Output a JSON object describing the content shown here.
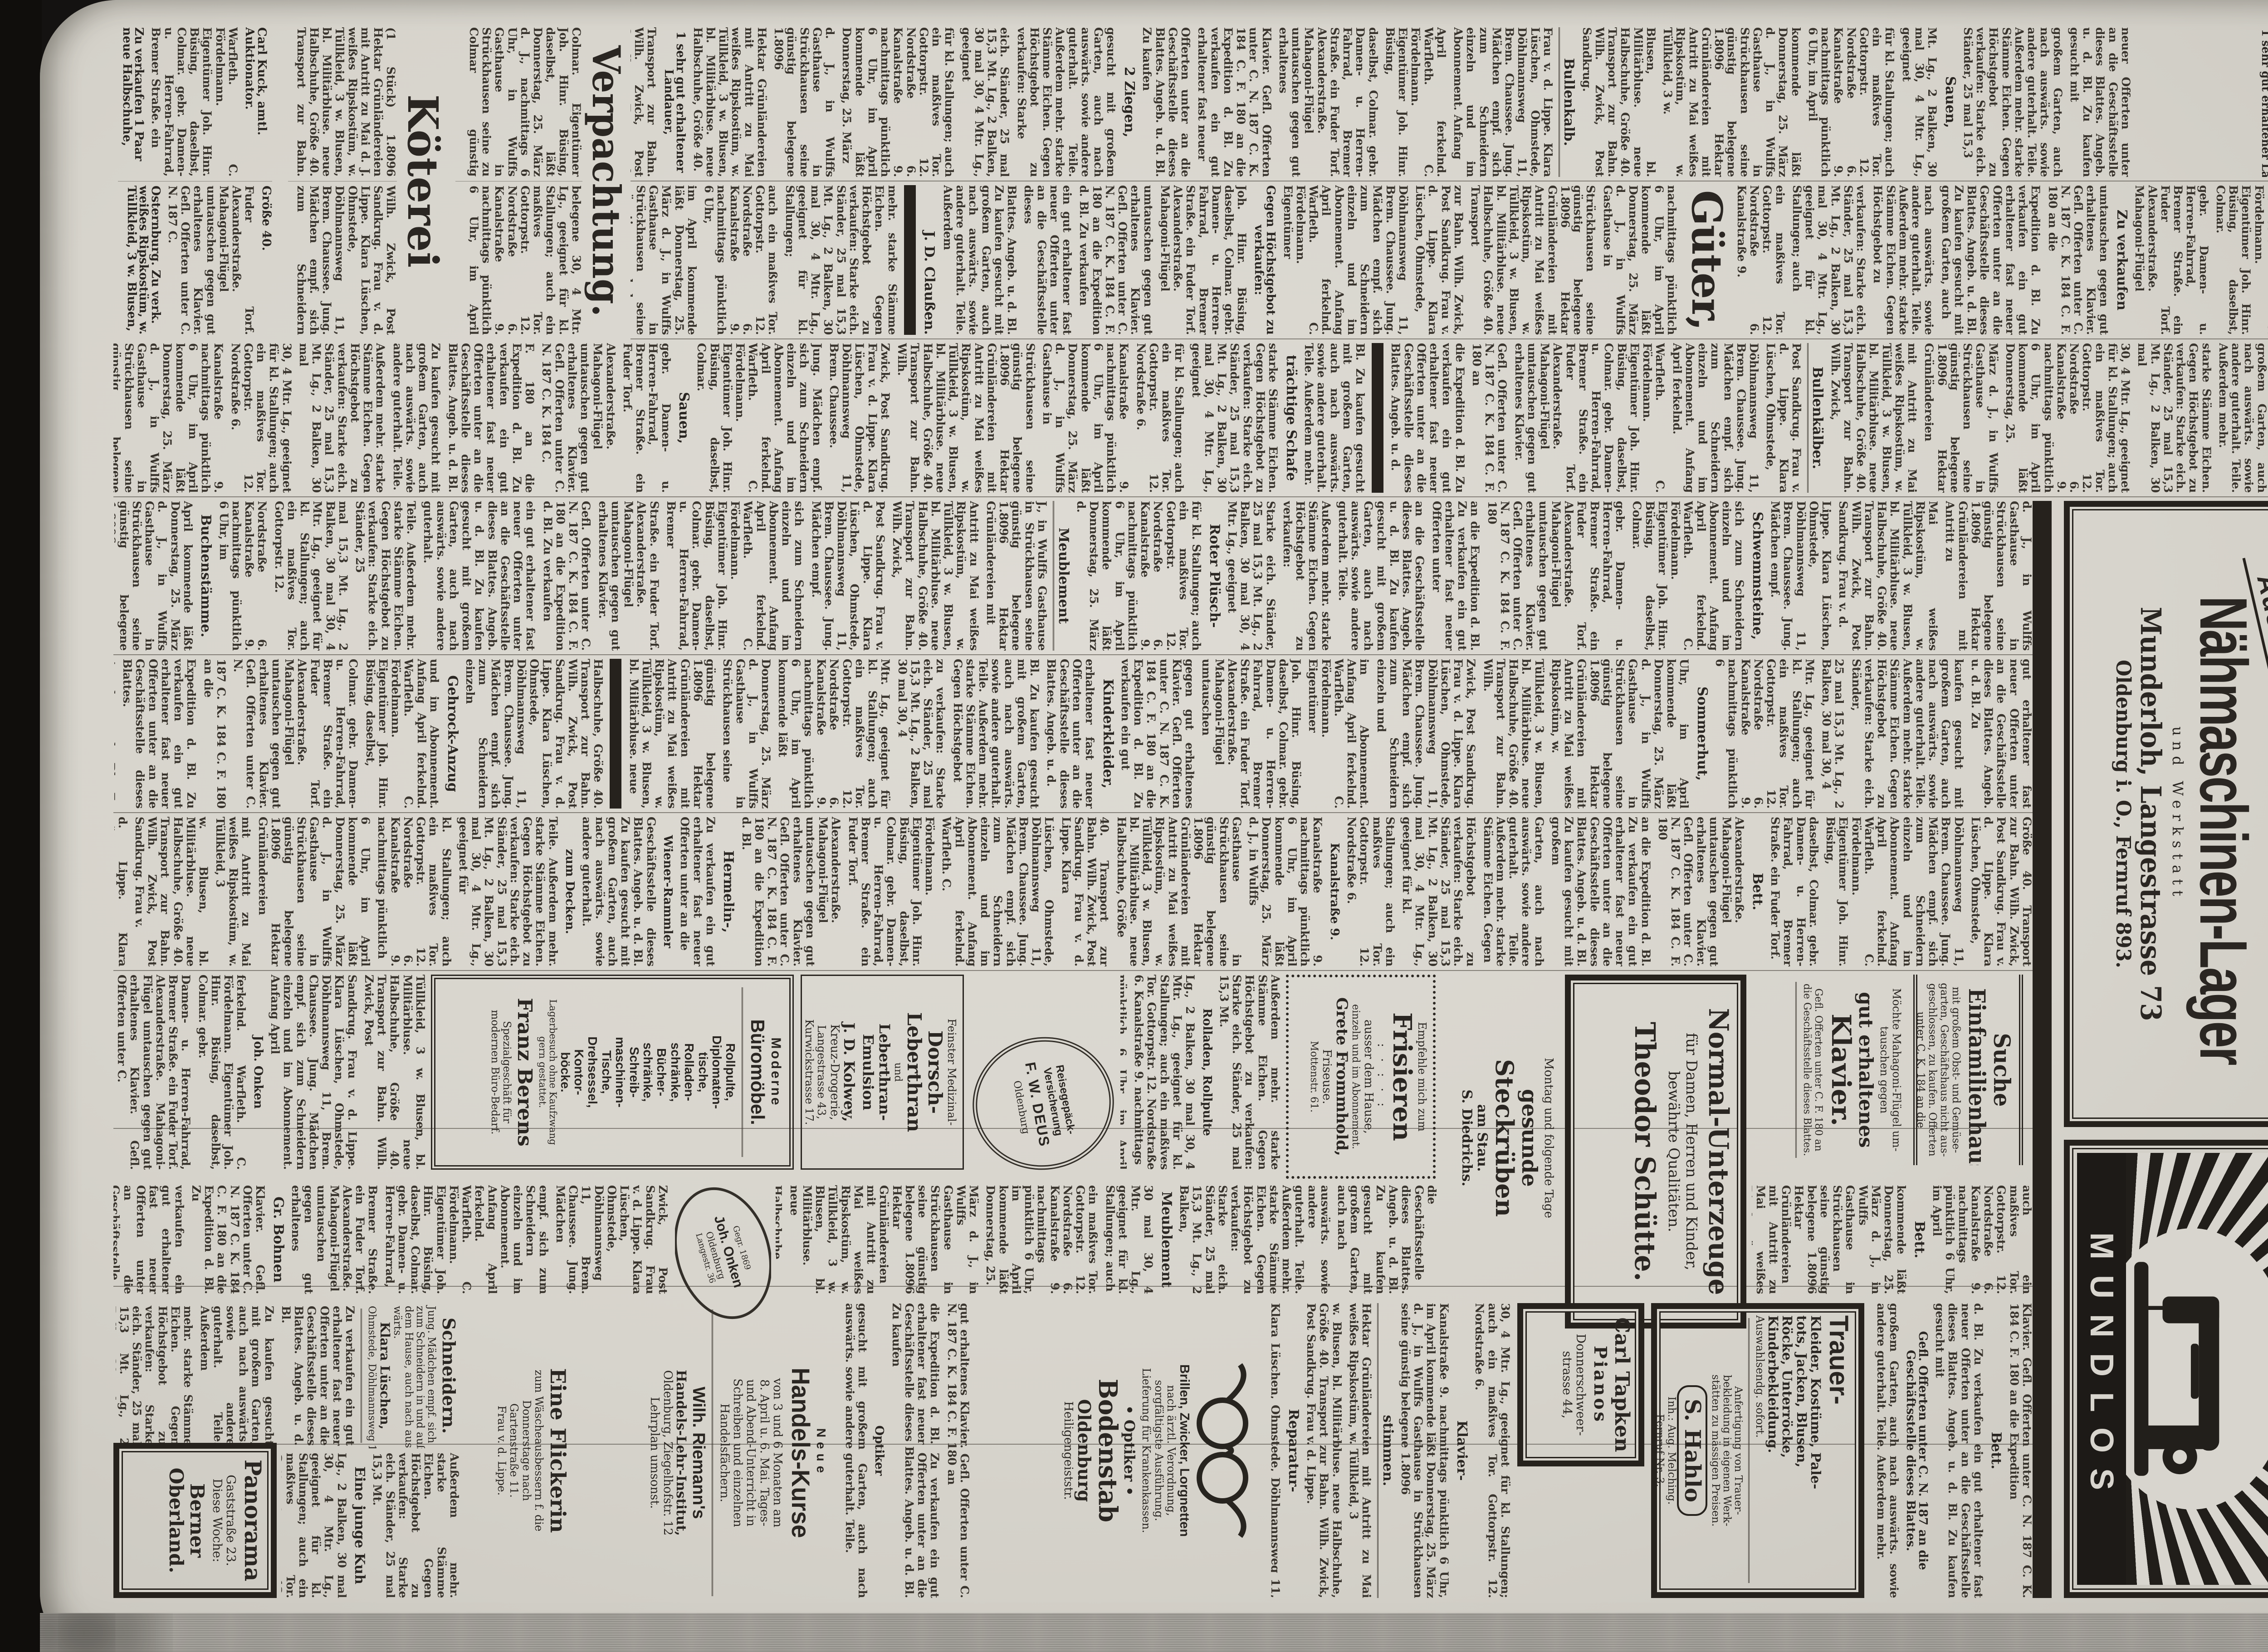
{
  "page_number": "889",
  "paper_colors": {
    "paper": "#d7d4cc",
    "ink": "#26221d",
    "faded_ink": "#39342d",
    "background": "#141211"
  },
  "masthead": {
    "title": "Nachzüge.",
    "lines": [
      "In der am",
      "Mittwoch, den 24. d. M.",
      "nachmittags pünktlich 1½ Uhr,",
      "stattfindenden Wagenauktion",
      "kommen ferner:"
    ],
    "items": [
      "1 Gespann bester ostpr. Pferde,",
      "1 10 Monat altes Bullenkalb,",
      "2 Ziegen, im April lammende,",
      "1 sehr gut erhaltener Landauer,"
    ]
  },
  "ads": {
    "munderloh": {
      "zahlung_box": "Alte Maschinen werden in Zahlung genommen",
      "auswahl": "Auswahl",
      "title": "Nähmaschinen-Lager",
      "sub": "und Werkstatt",
      "name_line": "Munderloh, Langestrasse 73",
      "city_line": "Oldenburg i. O., Fernruf 893."
    },
    "mundlos": {
      "brand": "MUNDLOS"
    },
    "suche_haus": [
      "Suche",
      "Einfamilienhaus",
      "mit großem Obst- und Gemüse-",
      "garten, Geschäftshaus nicht aus-",
      "geschlossen, zu kaufen. Offerten",
      "unter C. K. 184 an die",
      "Expedition d. Bl."
    ],
    "klavier": [
      "Möchte Mahagoni-Flügel um-",
      "tauschen gegen",
      "gut erhaltenes",
      "Klavier.",
      "Gefl. Offerten unter C. F. 180 an",
      "die Geschäftsstelle dieses Blattes."
    ],
    "schuette": [
      "Normal-Unterzeuge",
      "für Damen, Herren und Kinder,",
      "bewährte Qualitäten.",
      "Theodor Schütte."
    ],
    "steckrueben": [
      "Montag und folgende Tage",
      "gesunde",
      "Steckrüben",
      "am Stau.",
      "S. Diedrichs."
    ],
    "frisieren": [
      "Empfehle mich zum",
      "Frisieren",
      ": · : · :",
      "ausser dem Hause,",
      "einzeln und im Abonnement.",
      "Grete Frommhold,",
      "Friseuse.",
      "Mottenstr. 61."
    ],
    "trauer": [
      "Trauer-",
      "Kleider, Kostüme, Pale-",
      "tots, Jacken, Blusen,",
      "Röcke, Unterröcke,",
      "Kinderbekleidung.",
      "Auswahlsendg. sofort.",
      "Anfertigung von Trauer-",
      "bekleidung in eigenen Werk-",
      "stätten zu mässigen Preisen.",
      "S. Hahlo",
      "Inh.: Aug. Melching.",
      "Fernruf Nr. 3."
    ],
    "tapken": [
      "Carl Tapken",
      "Pianos",
      "Donnerschweer-",
      "strasse 44,"
    ],
    "optiker": [
      "Brillen, Zwicker, Lorgnetten",
      "nach ärztl. Verordnung,",
      "sorgfältigste Ausführung.",
      "Lieferung für Krankenkassen.",
      "• Optiker •",
      "Bodenstab",
      "Oldenburg",
      "Heiligengeiststr."
    ],
    "kurse": [
      "Neue",
      "Handels-Kurse",
      "von 3 und 6 Monaten am",
      "8. April u. 6. Mai. Tages-",
      "und Abend-Unterricht in",
      "Schreiben und einzelnen",
      "Handelsfächern.",
      "Wilh. Riemann's",
      "Handels-Lehr-Institut,",
      "Oldenburg, Ziegelhofstr. 12",
      "Lehrplan umsonst."
    ],
    "flickerin": [
      "Eine Flickerin",
      "zum Wäscheausbessern f. die",
      "Donnerstage nach",
      "Gartenstraße 11.",
      "Frau v. d. Lippe."
    ],
    "schneidern": [
      "Schneidern.",
      "Jung. Mädchen empf. sich",
      "zum Schneidern in und auß.",
      "dem Hause, auch nach aus-",
      "wärts.",
      "Klara Lüschen,",
      "Ohmstede, Döhlmannsweg 11."
    ],
    "panorama": [
      "Panorama",
      "Gaststraße 23.",
      "Diese Woche:",
      "Berner",
      "Oberland."
    ],
    "berens": [
      "Moderne",
      "Büromöbel.",
      "Rollpulte,",
      "Diplomaten-",
      "tische,",
      "Rolladen-",
      "schränke,",
      "Bücher-",
      "schränke,",
      "Schreib-",
      "maschinen-",
      "Tische,",
      "Drehsessel,",
      "Kontor-",
      "böcke.",
      "Lagerbesuch ohne Kaufzwang",
      "gern gestattet.",
      "Franz Berens",
      "Spezialgeschäft für",
      "modernen Büro-Bedarf."
    ],
    "kolwey": [
      "Feinster Medizinal-",
      "Dorsch-",
      "Leberthran",
      "und",
      "Leberthran-",
      "Emulsion",
      "J. D. Kolwey,",
      "Kreuz-Drogerie,",
      "Langestrasse 43,",
      "Kurwickstrasse 17."
    ],
    "deus": [
      "Reisegepäck-",
      "Versicherung",
      "F. W. DEUS",
      "Oldenburg"
    ],
    "onken": [
      "Gegr. 1869",
      "Joh. Onken",
      "Oldenburg",
      "Langestr. 36"
    ]
  },
  "zones": {
    "verpachtung": {
      "head": "Verpachtung.",
      "lead": "Colmar. Eigentümer Joh. Hinr. Büsing, daselbst, läßt Donnerstag, 25. März d. J., nachmittags 6 Uhr, in Wulffs Gasthause in Strückhausen seine zu Colmar günstig belegene"
    },
    "koeterei": {
      "head": "Köterei",
      "lead": "(1 Stück) 1.8096 Hektar Grünländereien mit Antritt zu Mai d. J."
    },
    "bottomleft": {
      "entries": [
        "Carl Kuck, amtl. Auktionator.",
        "Zu verkaufen 1 Paar neue Halbschuhe, Größe 40.",
        "Osternburg. Zu verk. weißes Ripskostüm, w. Tüllkleid, 3 w. Blusen, bl. Militärbluse. Nordstraße 6 II."
      ]
    }
  },
  "column_heads": {
    "c1": [
      {
        "at": 2,
        "t": "Sauen,"
      },
      {
        "at": 6,
        "t": "Bullenkalb.",
        "u": true
      },
      {
        "at": 11,
        "t": "2 Ziegen,"
      },
      {
        "at": 16,
        "t": "1 sehr gut erhaltener Landauer,",
        "small": true
      },
      {
        "at": 22,
        "t": "Wagenauktion",
        "u": true
      }
    ],
    "c2": [
      {
        "at": 3,
        "t": "Zu verkaufen"
      },
      {
        "at": 8,
        "t": "Güter,",
        "big": 92
      },
      {
        "at": 12,
        "t": "Gegen Höchstgebot zu verkaufen:",
        "small": true
      },
      {
        "at": 16,
        "t": "J. D. Claußen.",
        "sig": true
      },
      {
        "at": 16,
        "bar": true
      },
      {
        "at": 20,
        "t": "Marschwolle",
        "big": 56
      },
      {
        "at": 20,
        "t": "10 bis 12 Pfund"
      },
      {
        "at": 25,
        "t": "Anfang April ferkelnd.",
        "small": true
      },
      {
        "at": 25,
        "t": "Warfleth. C. Fördelmann.",
        "sig": true
      },
      {
        "at": 31,
        "t": "Zu tauschen ein Fuder Torf.",
        "small": true
      }
    ],
    "c3": [
      {
        "at": 2,
        "t": "Schweinestall,"
      },
      {
        "at": 7,
        "t": "Bullenkälber.",
        "u": true
      },
      {
        "at": 12,
        "bar": true
      },
      {
        "at": 13,
        "t": "trächtige Schafe"
      },
      {
        "at": 19,
        "t": "Sauen,"
      },
      {
        "at": 26,
        "t": "4 belegte Kühe"
      },
      {
        "at": 27,
        "t": "u. schwere",
        "small": true
      },
      {
        "at": 28,
        "t": "Weidebullen.",
        "u": true
      },
      {
        "at": 36,
        "t": "Osternburg.",
        "small": true
      },
      {
        "at": 42,
        "t": "Nordstraße 6.",
        "small": true
      }
    ],
    "c4": [
      {
        "at": 3,
        "t": "Schwemmsteine,"
      },
      {
        "at": 9,
        "t": "Roter Plüsch-"
      },
      {
        "at": 10,
        "t": "Meublement",
        "u": true
      },
      {
        "at": 20,
        "t": "Buchenstämme."
      },
      {
        "at": 30,
        "t": "Landstelle",
        "big": 62
      },
      {
        "at": 36,
        "t": "Zu kaufen gesucht:",
        "small": true
      },
      {
        "at": 40,
        "t": "Gr. Bohnen",
        "small": true
      }
    ],
    "c5": [
      {
        "at": 4,
        "t": "Sommerhut,"
      },
      {
        "at": 10,
        "t": "Kinderkleider,"
      },
      {
        "at": 16,
        "bar": true
      },
      {
        "at": 17,
        "t": "Gehrock-Anzug"
      },
      {
        "at": 24,
        "t": "Stutenfohlen"
      },
      {
        "at": 32,
        "t": "Größe 180",
        "small": true
      },
      {
        "at": 38,
        "t": "Nordstraße 6 II.",
        "small": true
      }
    ],
    "c6": [
      {
        "at": 3,
        "t": "Bett."
      },
      {
        "at": 8,
        "t": "Kanalstraße 9.",
        "small": true
      },
      {
        "at": 14,
        "t": "Hermelin-,"
      },
      {
        "at": 15,
        "t": "Wiener-Rammler",
        "small": true
      },
      {
        "at": 16,
        "t": "zum Decken.",
        "small": true
      },
      {
        "at": 24,
        "t": "Wagenpferd"
      },
      {
        "at": 32,
        "t": "Gottorpstr. 12.",
        "small": true
      },
      {
        "at": 38,
        "t": "Ang. u. C. E. 179",
        "small": true
      }
    ],
    "c7a": [
      {
        "at": 1,
        "t": "Rolladen, Rollpulte",
        "small": true
      }
    ],
    "c7b": [
      {
        "at": 2,
        "t": "Joh. Onken",
        "small": true
      },
      {
        "at": 5,
        "t": "Cutaway"
      }
    ],
    "c8a": [
      {
        "at": 1,
        "t": "Bett."
      },
      {
        "at": 4,
        "t": "Kanalstraße 9.",
        "small": true
      }
    ],
    "c8c": [
      {
        "at": 2,
        "t": "Meublement"
      },
      {
        "at": 8,
        "t": "Stutenfohlen"
      },
      {
        "at": 13,
        "t": "Ackerwagen."
      }
    ],
    "c8d": [
      {
        "at": 3,
        "t": "Gr. Bohnen"
      },
      {
        "at": 8,
        "t": "Friedhofs-",
        "small": true
      }
    ],
    "c910a": [
      {
        "at": 1,
        "t": "Bett."
      },
      {
        "at": 2,
        "t": "Gefl. Offerten unter C. N. 187 an die Geschäftsstelle dieses Blattes.",
        "small": true
      }
    ],
    "c910b": [
      {
        "at": 1,
        "t": "Klavier-"
      },
      {
        "at": 2,
        "t": "stimmen.",
        "u": true
      },
      {
        "at": 4,
        "t": "Reparatur-"
      },
      {
        "at": 5,
        "t": "werkstätte.",
        "u": true
      },
      {
        "at": 7,
        "t": "Familien-Aushilfe"
      },
      {
        "at": 9,
        "t": "Berlin W. 35,",
        "small": true
      }
    ],
    "c910c": [
      {
        "at": 2,
        "t": "Optiker",
        "small": true
      }
    ],
    "c910d": [
      {
        "at": 1,
        "t": "Eine junge Kuh"
      },
      {
        "at": 3,
        "t": "zu verkaufen.",
        "small": true
      }
    ]
  },
  "filler_words": [
    "Zu",
    "verkaufen",
    "ein",
    "gut",
    "erhaltener",
    "fast",
    "neuer",
    "Offerten",
    "unter",
    "an",
    "die",
    "Geschäftsstelle",
    "dieses",
    "Blattes.",
    "Angeb.",
    "u.",
    "d.",
    "Bl.",
    "Zu",
    "kaufen",
    "gesucht",
    "mit",
    "großem",
    "Garten,",
    "auch",
    "nach",
    "auswärts.",
    "sowie",
    "andere",
    "guterhalt.",
    "Teile.",
    "Außerdem",
    "mehr.",
    "starke",
    "Stämme",
    "Eichen.",
    "Gegen",
    "Höchstgebot",
    "zu",
    "verkaufen:",
    "Starke",
    "eich.",
    "Ständer,",
    "25",
    "mal",
    "15,3",
    "Mt.",
    "Lg.,",
    "2",
    "Balken,",
    "30",
    "mal",
    "30,",
    "4",
    "Mtr.",
    "Lg.,",
    "geeignet",
    "für",
    "kl.",
    "Stallungen;",
    "auch",
    "ein",
    "maßives",
    "Tor.",
    "Gottorpstr.",
    "12.",
    "Nordstraße",
    "6.",
    "Kanalstraße",
    "9.",
    "nachmittags",
    "pünktlich",
    "6",
    "Uhr,",
    "im",
    "April",
    "kommende",
    "läßt",
    "Donnerstag,",
    "25.",
    "März",
    "d.",
    "J.,",
    "in",
    "Wulffs",
    "Gasthause",
    "in",
    "Strückhausen",
    "seine",
    "günstig",
    "belegene",
    "1.8096",
    "Hektar",
    "Grünländereien",
    "mit",
    "Antritt",
    "zu",
    "Mai",
    "weißes",
    "Ripskostüm,",
    "w.",
    "Tüllkleid,",
    "3",
    "w.",
    "Blusen,",
    "bl.",
    "Militärbluse.",
    "neue",
    "Halbschuhe,",
    "Größe",
    "40.",
    "Transport",
    "zur",
    "Bahn.",
    "Wilh.",
    "Zwick,",
    "Post",
    "Sandkrug.",
    "Frau",
    "v.",
    "d.",
    "Lippe.",
    "Klara",
    "Lüschen,",
    "Ohmstede,",
    "Döhlmannsweg",
    "11,",
    "Brem.",
    "Chaussee.",
    "Jung.",
    "Mädchen",
    "empf.",
    "sich",
    "zum",
    "Schneidern",
    "einzeln",
    "und",
    "im",
    "Abonnement.",
    "Anfang",
    "April",
    "ferkelnd.",
    "Warfleth.",
    "C.",
    "Fördelmann.",
    "Eigentümer",
    "Joh.",
    "Hinr.",
    "Büsing,",
    "daselbst,",
    "Colmar.",
    "gebr.",
    "Damen-",
    "u.",
    "Herren-Fahrrad,",
    "Bremer",
    "Straße.",
    "ein",
    "Fuder",
    "Torf.",
    "Alexanderstraße.",
    "Mahagoni-Flügel",
    "umtauschen",
    "gegen",
    "gut",
    "erhaltenes",
    "Klavier.",
    "Gefl.",
    "Offerten",
    "unter",
    "C.",
    "N.",
    "187",
    "C.",
    "K.",
    "184",
    "C.",
    "F.",
    "180",
    "an",
    "die",
    "Expedition",
    "d.",
    "Bl."
  ]
}
